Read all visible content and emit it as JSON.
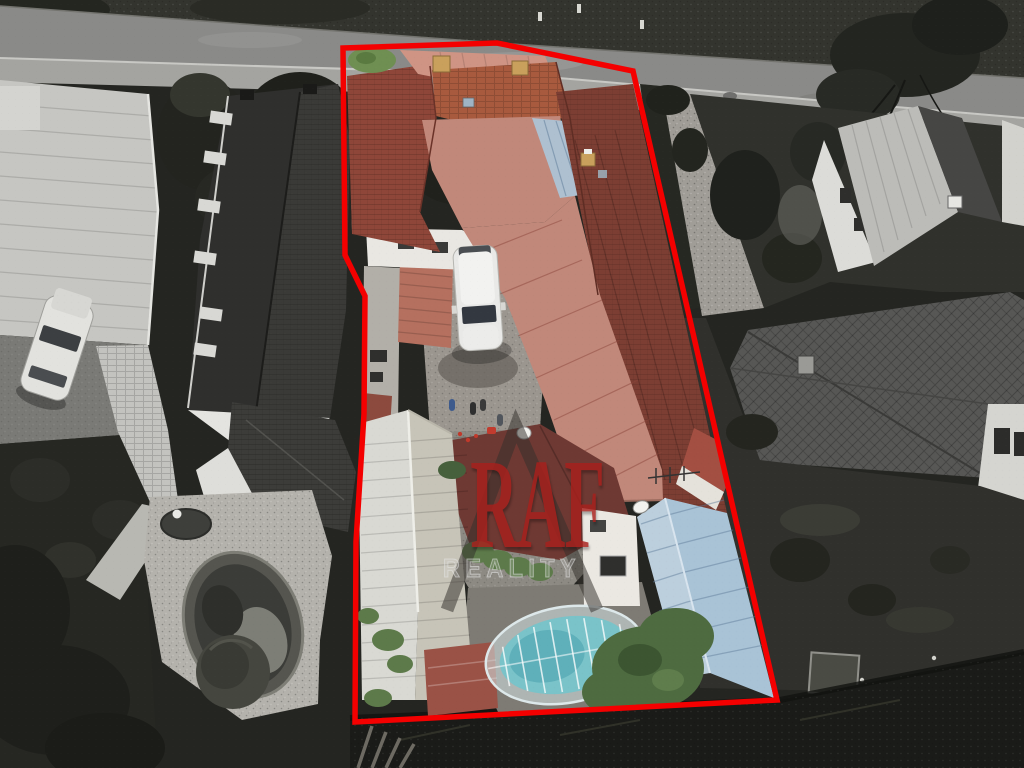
{
  "watermark": {
    "brand": "RAF",
    "subtitle": "REALITY",
    "logo_icon": "roof-triangle-icon"
  },
  "colors": {
    "outline_red": "#f40000",
    "watermark_red": "#a8201c",
    "watermark_triangle": "#34302d",
    "tile_roof": "#8e4639",
    "tile_roof_dark": "#7c3e33",
    "tile_roof_light": "#a85a3e",
    "salmon_metal": "#c1887a",
    "salmon_light": "#cf9484",
    "blue_patch": "#aec0d0",
    "blue_roof": "#a9c3d6",
    "blue_roof_light": "#bccfdd",
    "silver_roof": "#d9d9d3",
    "silver_roof_dark": "#c7c4b8",
    "maroon_roof": "#6e3933",
    "red_wall": "#a34f42",
    "pool_water": "#7ac3c9",
    "pool_deep": "#5fb0ba",
    "tree_green": "#4e6b40",
    "bush_green": "#6f8f52",
    "hedge_green": "#5d7a4a",
    "chimney_tan": "#c9a05c"
  }
}
